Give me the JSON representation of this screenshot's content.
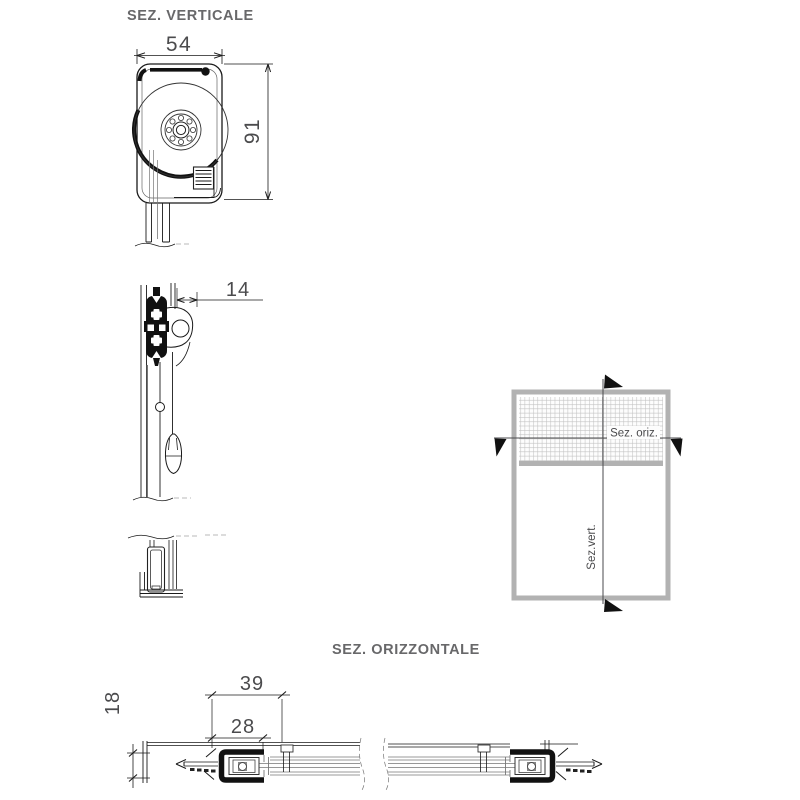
{
  "vertical_section": {
    "title": "SEZ. VERTICALE",
    "dim_box_width": "54",
    "dim_box_height": "91",
    "dim_bar_offset": "14"
  },
  "horizontal_section": {
    "title": "SEZ. ORIZZONTALE",
    "dim_guide_overall": "39",
    "dim_guide_inner": "28",
    "dim_guide_depth": "18"
  },
  "window_schematic": {
    "horizontal_cut_label": "Sez. oriz.",
    "vertical_cut_label": "Sez.vert."
  },
  "colors": {
    "line": "#1a1a1a",
    "title_text": "#68686a",
    "dim_text": "#4b4b4d",
    "schematic_gray": "#b2b2b2",
    "mesh_line": "#c2c2c2"
  }
}
